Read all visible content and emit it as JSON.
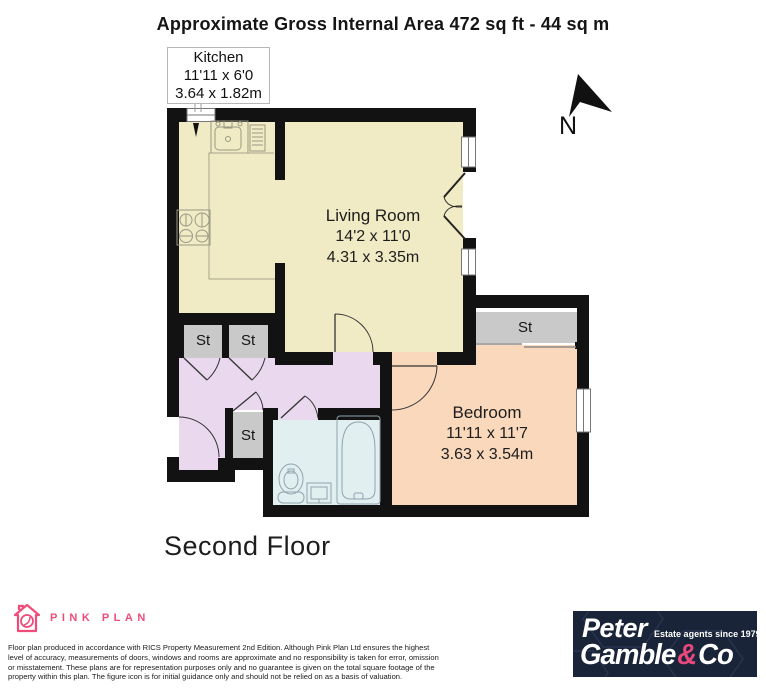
{
  "title": "Approximate Gross Internal Area 472 sq ft - 44 sq m",
  "north_label": "N",
  "rooms": {
    "kitchen": {
      "name": "Kitchen",
      "imperial": "11'11 x 6'0",
      "metric": "3.64 x 1.82m"
    },
    "living": {
      "name": "Living Room",
      "imperial": "14'2 x 11'0",
      "metric": "4.31 x 3.35m"
    },
    "bedroom": {
      "name": "Bedroom",
      "imperial": "11'11 x 11'7",
      "metric": "3.63 x 3.54m"
    },
    "storage_label": "St"
  },
  "floor_label": "Second Floor",
  "footer": {
    "pink_plan": {
      "brand": "PINK PLAN"
    },
    "disclaimer": [
      "Floor plan produced in accordance with RICS Property Measurement 2nd Edition. Although Pink Plan Ltd ensures the highest",
      "level of accuracy, measurements of doors, windows and rooms are approximate and no responsibility is taken for error, omission",
      "or misstatement. These plans are for representation purposes only and no guarantee is given on the total square footage of the",
      "property within this plan. The figure icon is for initial guidance only and should not be relied on as a basis of valuation."
    ],
    "agent": {
      "name1": "Peter",
      "tagline": "Estate agents since 1979",
      "name2": "Gamble",
      "amp": "&",
      "name3": "Co"
    }
  },
  "colors": {
    "wall": "#121212",
    "room-yellow": "#f0ebc4",
    "room-peach": "#f9d8bc",
    "room-lavender": "#e9d8ee",
    "room-blue": "#e2eff1",
    "storage-gray": "#c9c9c9",
    "pink": "#ee4d79",
    "navy": "#1a2438",
    "amp-pink": "#e8487c"
  }
}
